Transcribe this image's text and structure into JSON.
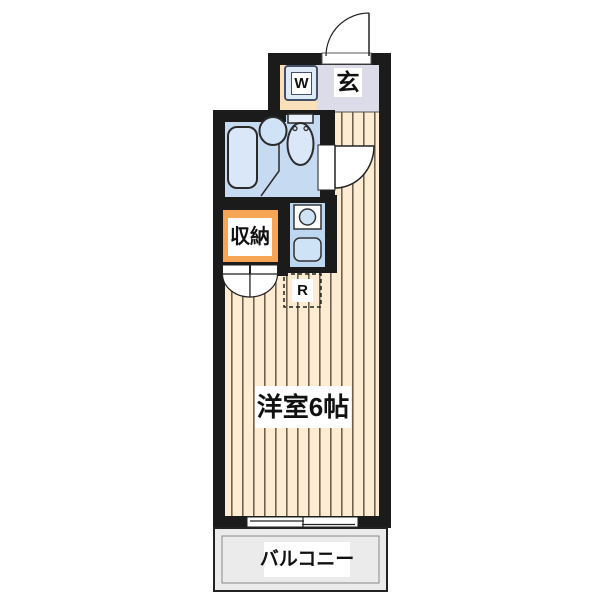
{
  "floorplan": {
    "unit_labels": {
      "entrance": "玄",
      "washing_machine": "W",
      "storage": "収納",
      "refrigerator": "R",
      "main_room": "洋室6帖",
      "balcony": "バルコニー"
    },
    "colors": {
      "wall": "#1b1b1b",
      "flooring": "#fdecd2",
      "flooring_stripe": "#6f6250",
      "entrance_floor": "#dcdce8",
      "step_floor": "#f9dfba",
      "bathroom_floor": "#c6daf2",
      "fixture_fill": "#d9e7f8",
      "kitchen_floor": "#bed7f0",
      "storage_accent": "#f6a455",
      "balcony_floor": "#ebebeb",
      "label_text": "#111111"
    }
  }
}
